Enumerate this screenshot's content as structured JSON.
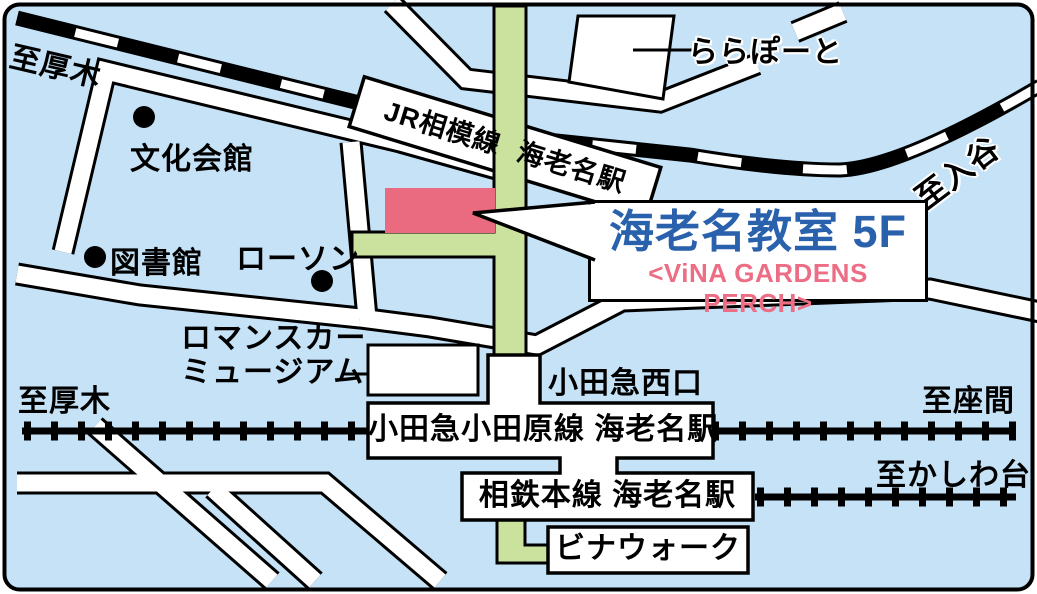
{
  "callout": {
    "title": "海老名教室 5F",
    "subtitle": "<ViNA GARDENS PERCH>"
  },
  "railways": {
    "jr_label": "JR相模線 海老名駅",
    "odakyu_label": "小田急小田原線 海老名駅",
    "sotetsu_label": "相鉄本線 海老名駅"
  },
  "directions": {
    "atsugi_top": "至厚木",
    "atsugi_bottom": "至厚木",
    "iriya": "至入谷",
    "zama": "至座間",
    "kashiwadai": "至かしわ台"
  },
  "landmarks": {
    "lalaport": "ららぽーと",
    "bunka_kaikan": "文化会館",
    "library": "図書館",
    "lawson": "ローソン",
    "romancecar_line1": "ロマンスカー",
    "romancecar_line2": "ミュージアム",
    "odakyu_west_exit": "小田急西口",
    "vinawalk": "ビナウォーク"
  },
  "colors": {
    "map_background": "#c5e2f7",
    "road_fill": "#ffffff",
    "outline_black": "#000000",
    "walkway_green": "#cbe29e",
    "target_building_pink": "#ea6b80",
    "callout_title_blue": "#2a61ac",
    "callout_subtitle_pink": "#ed6d85"
  }
}
